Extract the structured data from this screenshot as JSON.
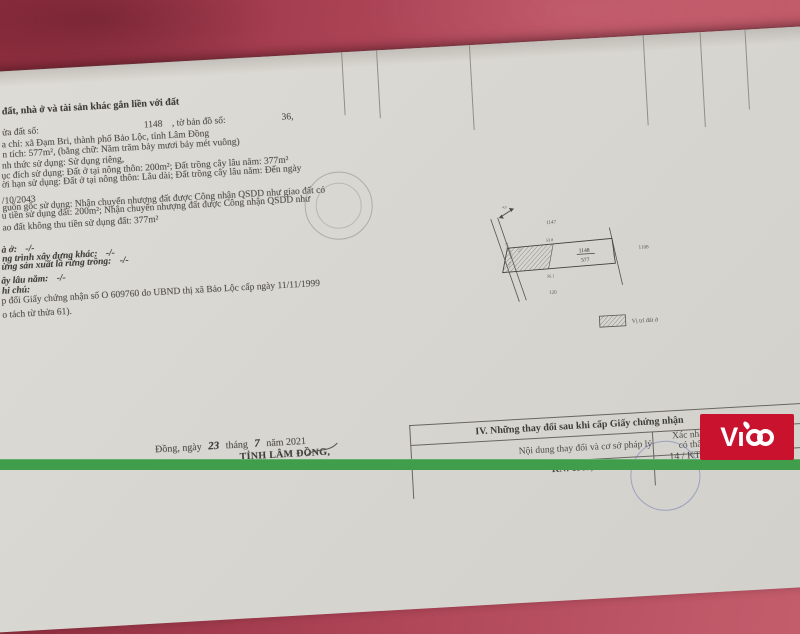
{
  "colors": {
    "background": "#aa4254",
    "paper": "#d8d6d0",
    "green_bar": "#3f9d4b",
    "logo_red": "#c8122e",
    "ink": "#53514b",
    "ink_blue": "#3c50a0"
  },
  "doc": {
    "section_header": "đất, nhà ở và tài sản khác gắn liền với đất",
    "parcel_row": {
      "label": "ửa đất số:",
      "number": "1148",
      "map_label": ", tờ bản đồ số:",
      "map_number": "36,"
    },
    "rows": [
      {
        "t": "a chỉ: xã Đạm Bri, thành phố Bảo Lộc, tỉnh Lâm Đồng"
      },
      {
        "t": "n tích: 577m², (bằng chữ: Năm trăm bảy mươi bảy mét vuông)"
      },
      {
        "t": "nh thức sử dụng:  Sử dụng riêng,"
      },
      {
        "t": "ục đích sử dụng:  Đất ở tại nông thôn: 200m²; Đất trồng cây lâu năm: 377m²"
      },
      {
        "t": "ời hạn sử dụng:  Đất ở tại nông thôn: Lâu dài; Đất trồng cây lâu năm: Đến ngày"
      },
      {
        "t": "/10/2043"
      },
      {
        "t": "guồn gốc sử dụng: Nhận chuyển nhượng đất được Công nhận QSDD như giao đất có"
      },
      {
        "t": "u tiền sử dụng đất: 200m²; Nhận chuyển nhượng đất được Công nhận QSDD như"
      },
      {
        "t": "ao đất không thu tiền sử dụng đất: 377m²"
      }
    ],
    "label_rows": [
      {
        "label": "à ở:",
        "value": "-/-"
      },
      {
        "label": "ng trình xây dựng khác:",
        "value": "-/-"
      },
      {
        "label": "ừng sản xuất là rừng trồng:",
        "value": "-/-"
      },
      {
        "label": "ây lâu năm:",
        "value": "-/-"
      },
      {
        "label": "hi chú:",
        "value": ""
      }
    ],
    "note1": "p đổi Giấy chứng nhận số O 609760 do UBND thị xã Bảo Lộc cấp ngày 11/11/1999",
    "note2": "o tách từ thửa 61).",
    "date": {
      "prefix": "Đồng, ngày",
      "day": "23",
      "thang": "tháng",
      "month": "7",
      "year": "năm 2021"
    },
    "issuer": "TỈNH LÂM ĐỒNG,"
  },
  "diagram": {
    "north_label": "4,0",
    "neighbor_top": "1147",
    "dim_top": "53.8",
    "parcel_number": "1148",
    "parcel_area": "577",
    "dim_bottom": "56.1",
    "neighbor_bottom": "120",
    "neighbor_right": "1108",
    "dim_small_1": "13.5",
    "dim_small_2": "15.9",
    "dim_small_3": "5.3",
    "road_label": "ĐƯỜNG",
    "legend_label": "Vị trí đất ở"
  },
  "table4": {
    "title": "IV. Những thay đổi sau khi cấp Giấy chứng nhận",
    "col_left": "Nội dung thay đổi và cơ sở pháp lý",
    "col_right_line1": "Xác nhận",
    "col_right_line2": "có thẩ",
    "row_fragment": "KN: 1967, CMND số:",
    "hand_line1": "14 / KT",
    "hand_line2": "Phê"
  },
  "watermark": {
    "letters": "Vı",
    "brand": "ViCo"
  }
}
